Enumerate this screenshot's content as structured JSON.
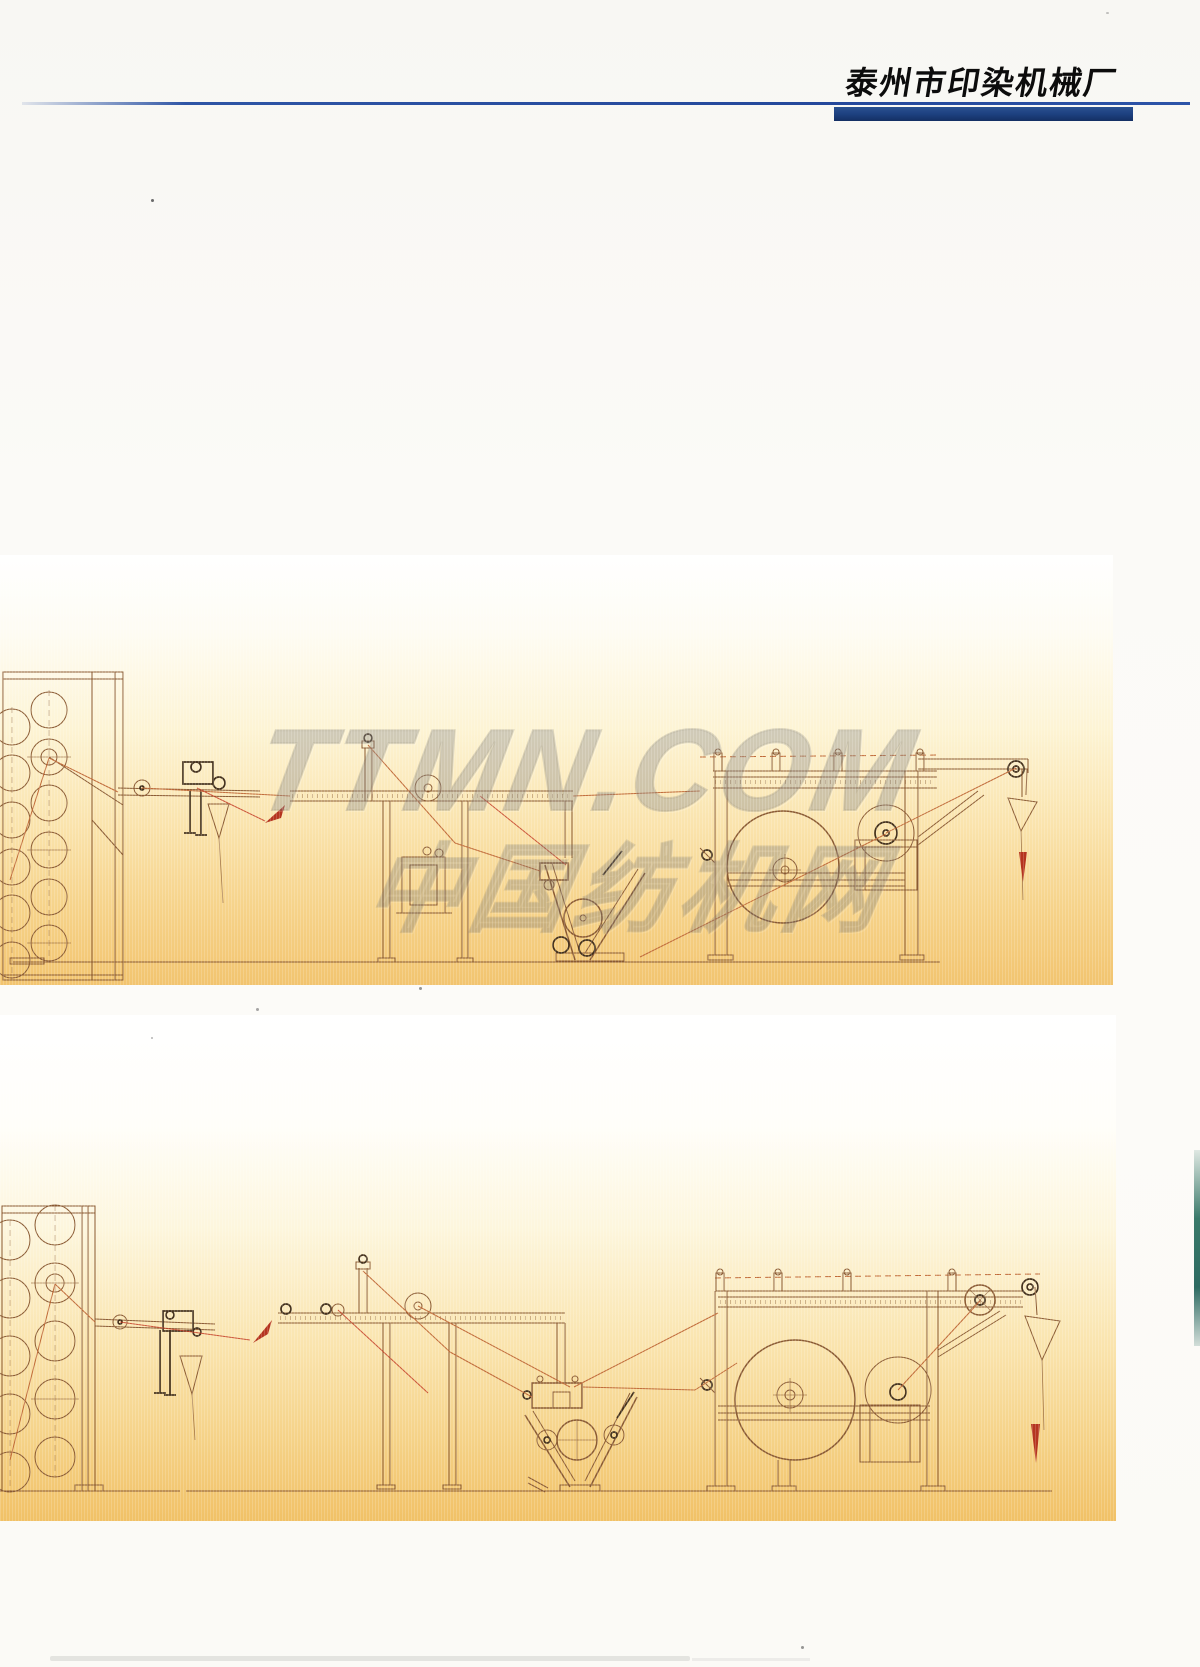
{
  "header": {
    "title": "泰州市印染机械厂"
  },
  "watermark": {
    "line1": "TTMN.COM",
    "line2": "中国纺机网"
  },
  "colors": {
    "page-bg": "#f9f8f4",
    "rule-blue": "#2e55a5",
    "accent-bar": "#1c3f7e",
    "band-orange": "#f2c46f",
    "band-yellow": "#fdf4d5",
    "ink-sepia": "#8a5a33",
    "ink-dark": "#43301c",
    "accent-red": "#b5341f",
    "thread-orange": "#c06a38",
    "edge-teal": "#3a7a6a",
    "watermark-gray": "#8f8f8f"
  }
}
